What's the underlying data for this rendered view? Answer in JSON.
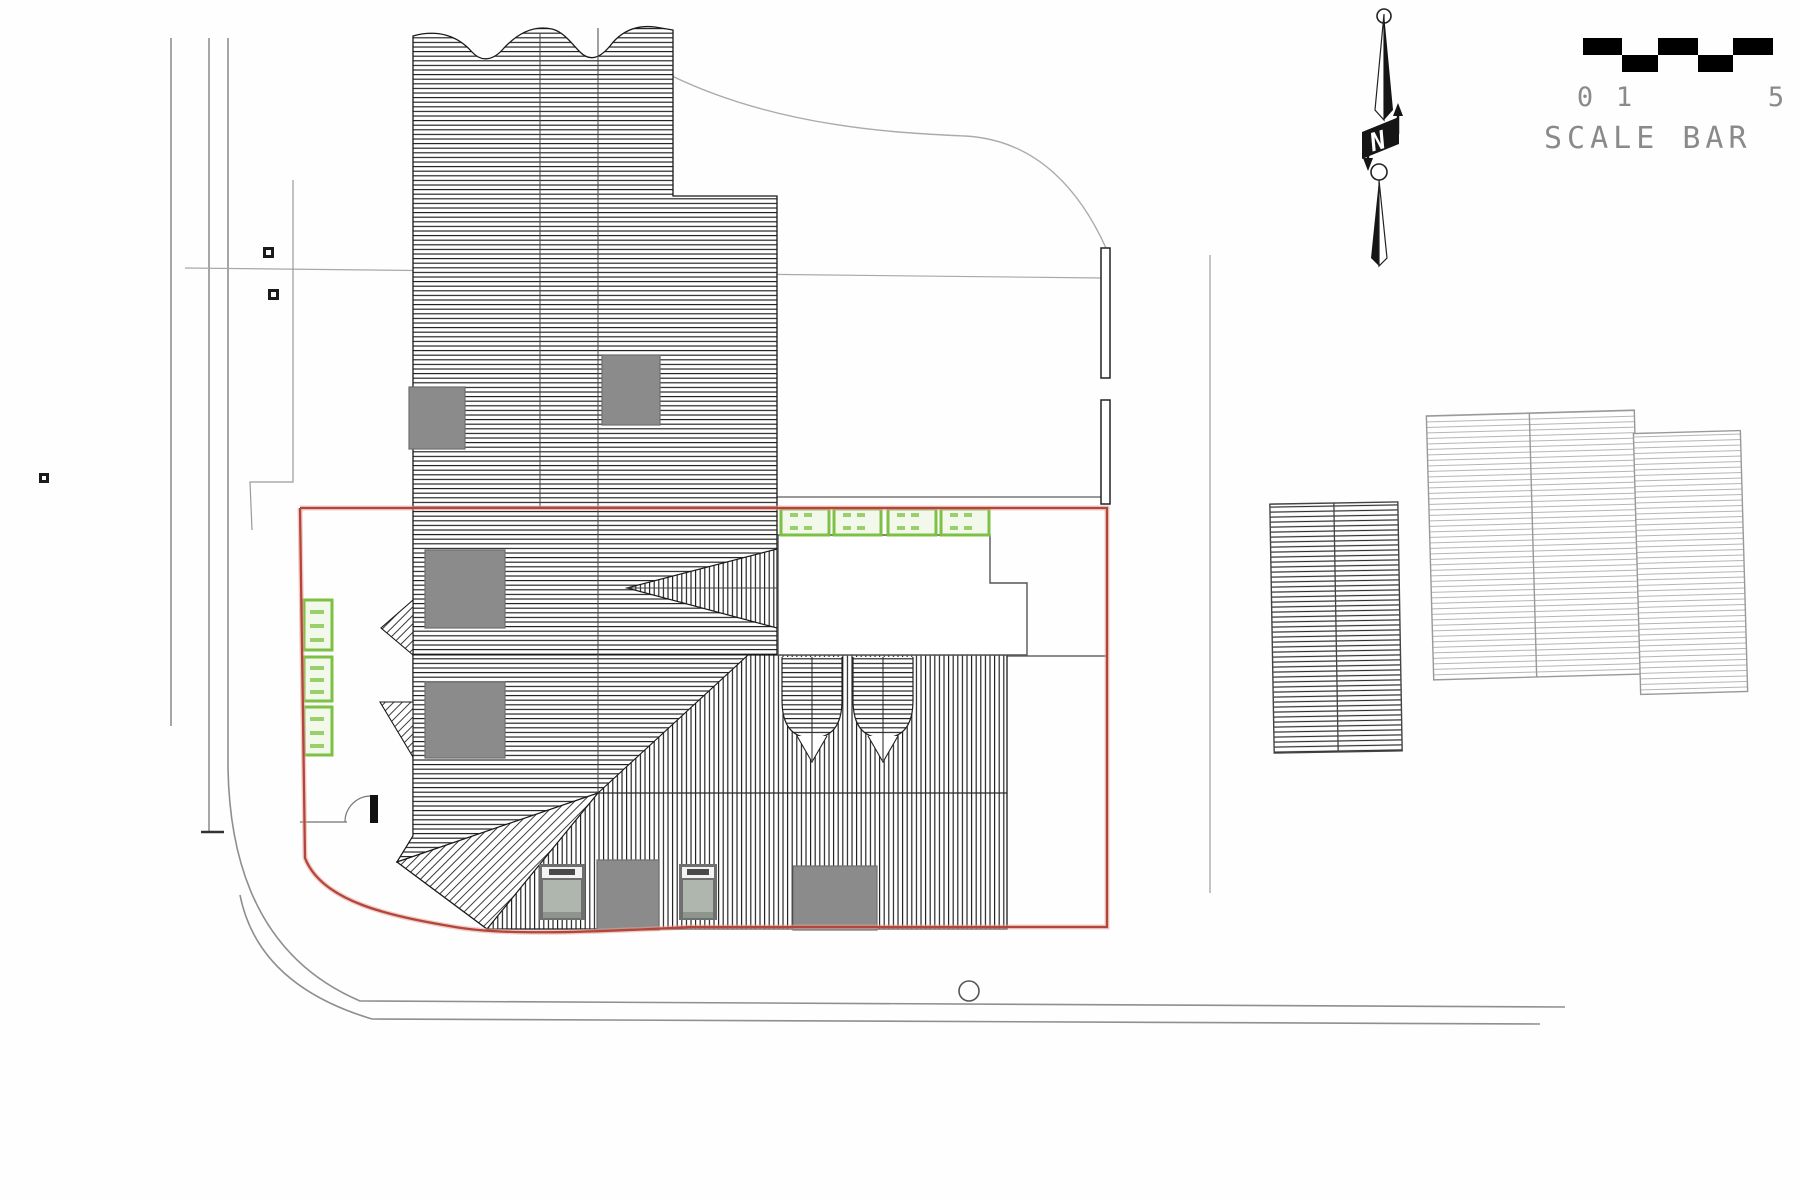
{
  "scale_bar": {
    "label": "SCALE BAR",
    "tick_0": "0",
    "tick_1": "1",
    "tick_5": "5",
    "segments": 5,
    "block_color": "#000000",
    "text_color": "#8a8a8a"
  },
  "north_arrow": {
    "letter": "N"
  },
  "colors": {
    "site_boundary_red": "#b5453a",
    "boundary_halo": "#e0a59c",
    "green_rooflight": "#7cc143",
    "green_rooflight_fill": "#f2f8ea",
    "gray_skylight": "#8b8b8b",
    "velux_glass": "#aeb6ae",
    "hatch_dark": "#1c1c1c",
    "hatch_light": "#b5b5b5",
    "road_line": "#8f8f8f",
    "outline": "#1a1a1a"
  },
  "features": {
    "green_rooflights_left_count": 3,
    "green_rooflights_top_count": 4,
    "gray_skylights_count": 6,
    "velux_units_count": 2,
    "barrel_dormers_count": 2,
    "neighbour_buildings_count": 3
  }
}
